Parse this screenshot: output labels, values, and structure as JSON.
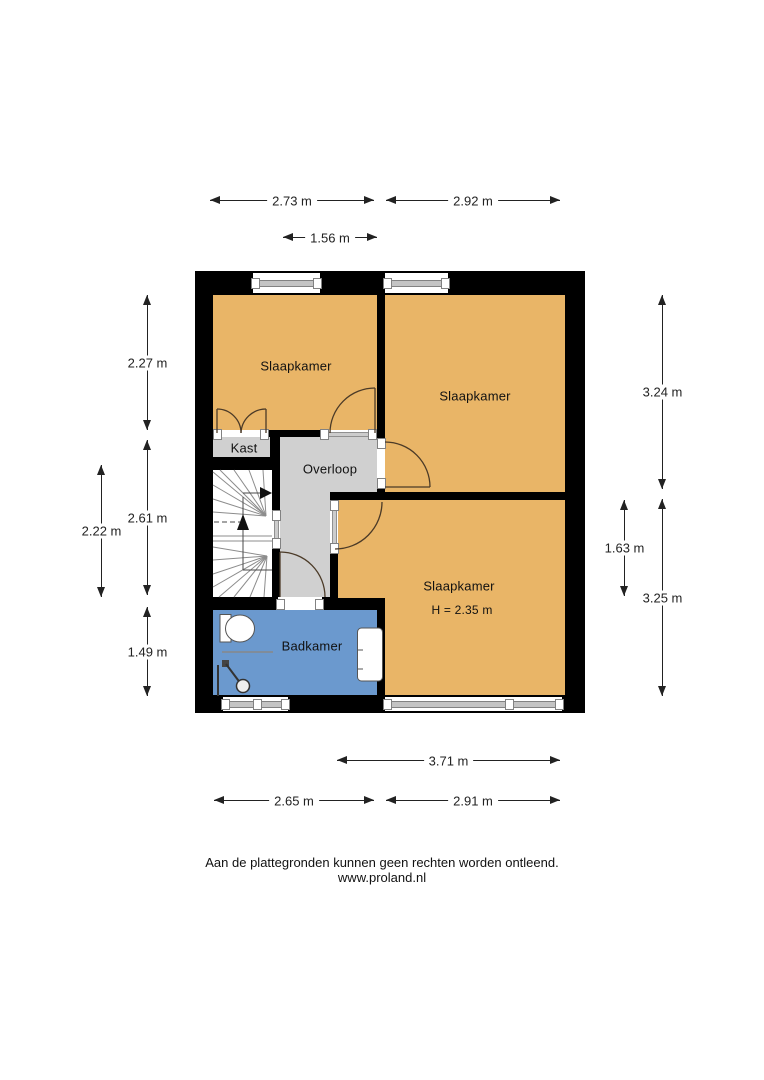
{
  "plan": {
    "rooms": {
      "bedroom_top_left": {
        "label": "Slaapkamer"
      },
      "bedroom_top_right": {
        "label": "Slaapkamer"
      },
      "bedroom_bottom_right": {
        "label": "Slaapkamer",
        "note": "H = 2.35 m"
      },
      "kast": {
        "label": "Kast"
      },
      "overloop": {
        "label": "Overloop"
      },
      "badkamer": {
        "label": "Badkamer"
      }
    },
    "dims": {
      "top1": {
        "label": "2.73 m"
      },
      "top2": {
        "label": "2.92 m"
      },
      "top3": {
        "label": "1.56 m"
      },
      "left1": {
        "label": "2.27 m"
      },
      "left2": {
        "label": "2.61 m"
      },
      "left3": {
        "label": "2.22 m"
      },
      "left4": {
        "label": "1.49 m"
      },
      "right1": {
        "label": "3.24 m"
      },
      "right2": {
        "label": "1.63 m"
      },
      "right3": {
        "label": "3.25 m"
      },
      "bottom1": {
        "label": "3.71 m"
      },
      "bottom2": {
        "label": "2.65 m"
      },
      "bottom3": {
        "label": "2.91 m"
      }
    },
    "colors": {
      "wall": "#000000",
      "bedroom": "#E9B567",
      "hall": "#D0D0D0",
      "bathroom": "#6B99CE",
      "dimension_text": "#222222",
      "door_arc": "#4B3A27"
    }
  },
  "footer": {
    "disclaimer": "Aan de plattegronden kunnen geen rechten worden ontleend.",
    "website": "www.proland.nl"
  }
}
